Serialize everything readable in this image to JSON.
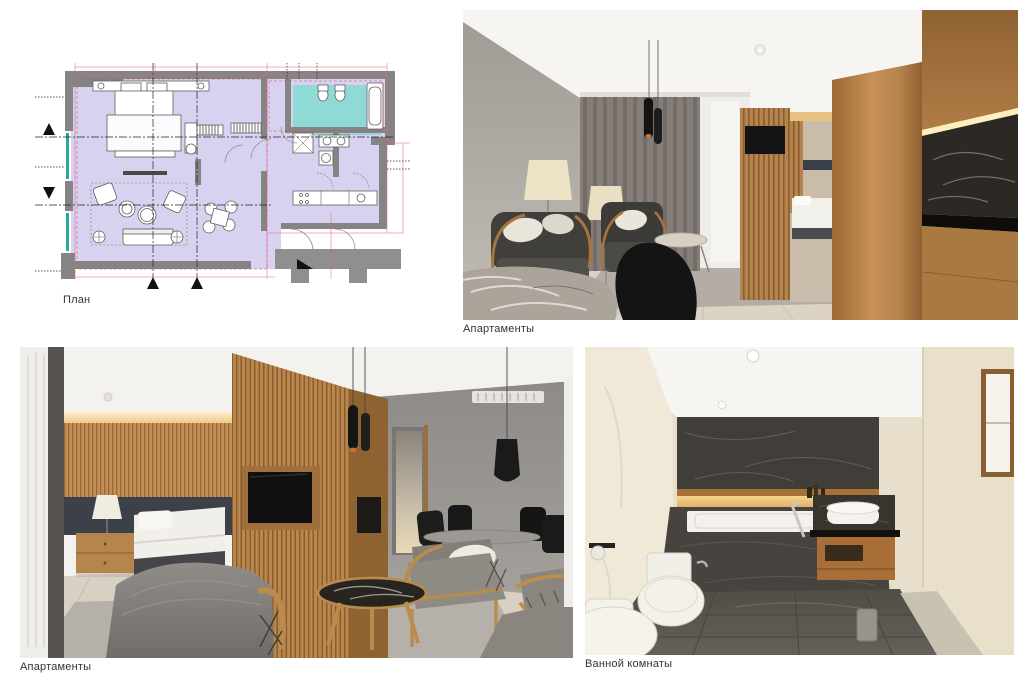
{
  "figures": {
    "plan": {
      "caption": "План",
      "type": "floor-plan"
    },
    "apartment_top": {
      "caption": "Апартаменты",
      "type": "render"
    },
    "apartment_bottom": {
      "caption": "Апартаменты",
      "type": "render"
    },
    "bathroom": {
      "caption": "Ванной комнаты",
      "type": "render"
    }
  },
  "palette": {
    "background": "#ffffff",
    "caption_text": "#333333",
    "plan_wall_gray": "#848484",
    "plan_floor_lavender": "#d8d2f0",
    "plan_bathroom_cyan": "#90dad6",
    "plan_dimension_pink": "#e0647e",
    "plan_window_teal": "#2fa89c",
    "wood_light": "#c89158",
    "wood_mid": "#b5834d",
    "wood_dark": "#8a5c2e",
    "wall_gray": "#9a948e",
    "curtain_gray": "#857d77",
    "floor_wood": "#d9d0c2",
    "rug_gray": "#b4aea6",
    "marble_dark": "#2c2823",
    "bath_cream": "#e8dfca",
    "bath_stone": "#474440",
    "glow_amber": "#f3c87e"
  }
}
